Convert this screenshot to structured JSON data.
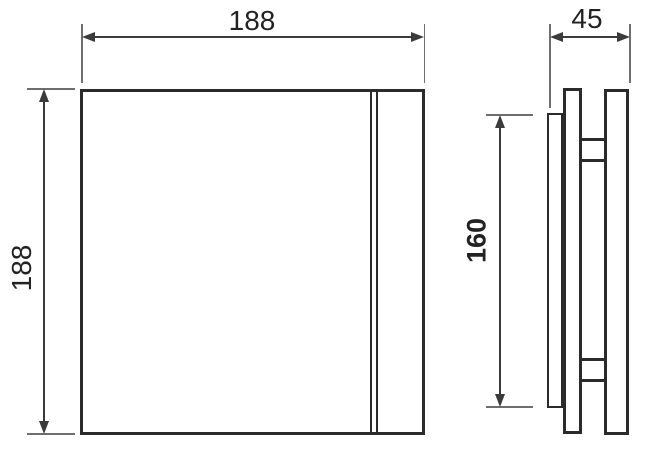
{
  "colors": {
    "background": "#ffffff",
    "outline": "#2b2b2b",
    "dimension": "#3b3b3b",
    "extension": "#6e6e6e",
    "text": "#222222"
  },
  "dimensions": {
    "front_width": "188",
    "front_height": "188",
    "side_depth": "45",
    "side_inner_height": "160"
  }
}
